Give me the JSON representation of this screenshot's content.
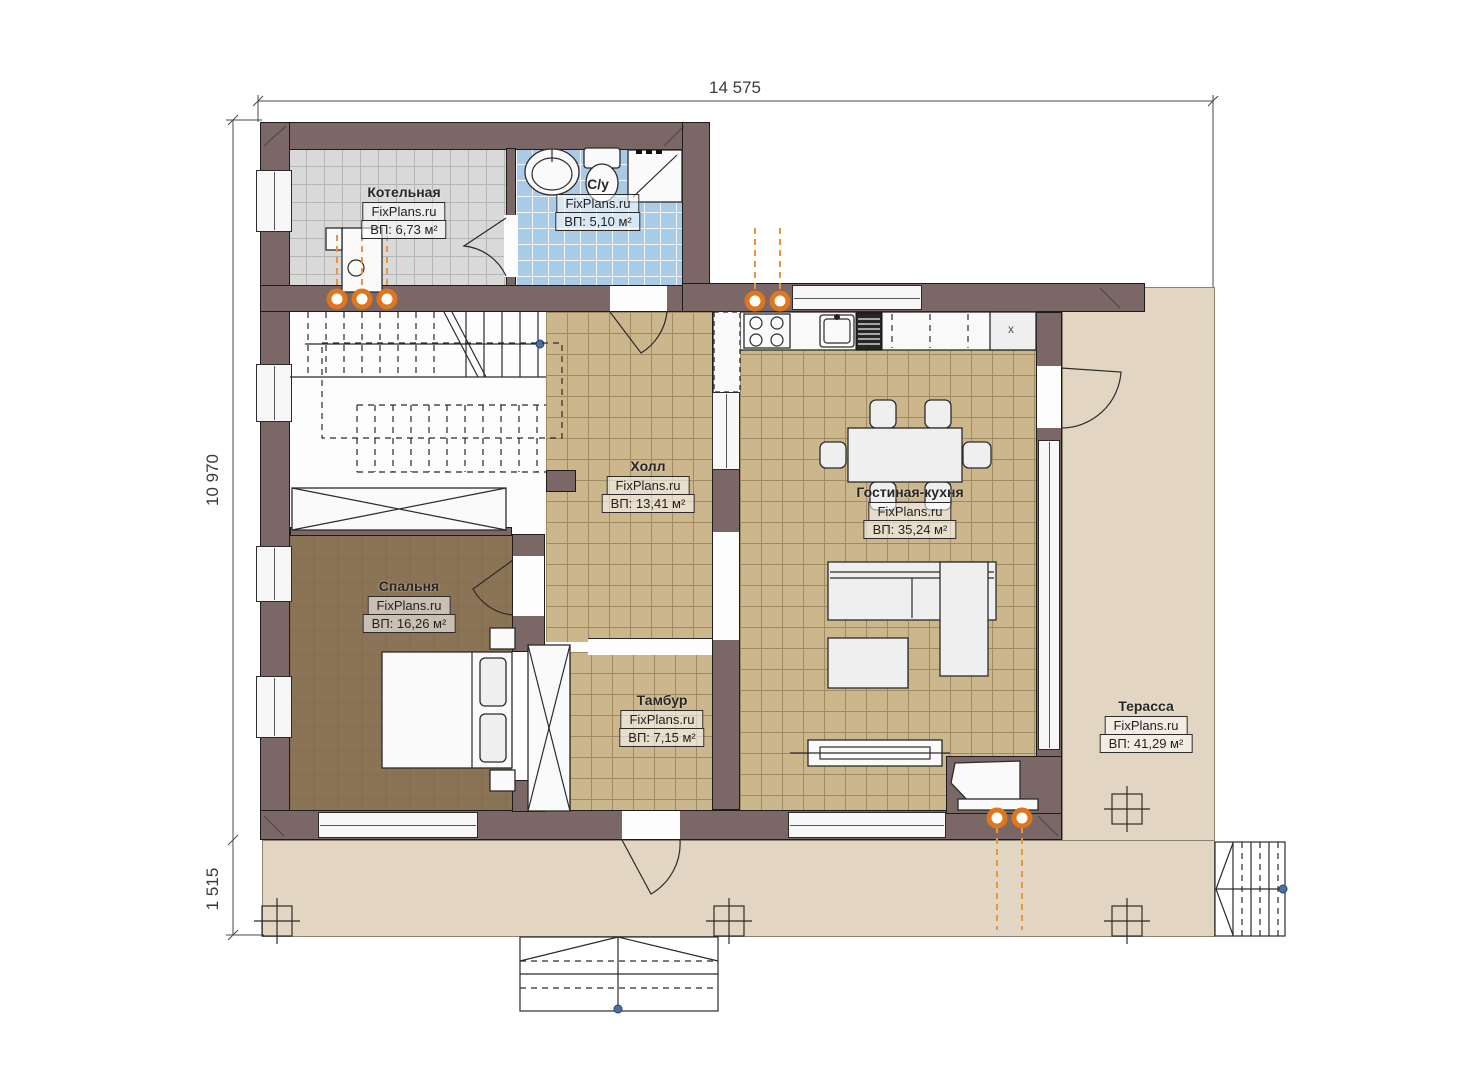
{
  "meta": {
    "drawing_type": "first floor plan",
    "watermark": "FixPlans.ru"
  },
  "dimensions": {
    "overall_width": "14 575",
    "overall_height": "10 970",
    "porch_depth": "1 515"
  },
  "rooms": [
    {
      "id": "boiler",
      "name": "Котельная",
      "watermark": "FixPlans.ru",
      "area": "ВП: 6,73 м²"
    },
    {
      "id": "bathroom",
      "name": "С/у",
      "watermark": "FixPlans.ru",
      "area": "ВП: 5,10 м²"
    },
    {
      "id": "hall",
      "name": "Холл",
      "watermark": "FixPlans.ru",
      "area": "ВП: 13,41 м²"
    },
    {
      "id": "living-kitchen",
      "name": "Гостиная-кухня",
      "watermark": "FixPlans.ru",
      "area": "ВП: 35,24 м²"
    },
    {
      "id": "bedroom",
      "name": "Спальня",
      "watermark": "FixPlans.ru",
      "area": "ВП: 16,26 м²"
    },
    {
      "id": "vestibule",
      "name": "Тамбур",
      "watermark": "FixPlans.ru",
      "area": "ВП: 7,15 м²"
    },
    {
      "id": "terrace",
      "name": "Терасса",
      "watermark": "FixPlans.ru",
      "area": "ВП: 41,29 м²"
    }
  ],
  "kitchen": {
    "cabinet_mark": "x"
  },
  "colors": {
    "wall": "#7b6766",
    "floor_boiler": "#d9d9d9",
    "floor_bathroom": "#a9cbe8",
    "floor_tiles": "#ccb68c",
    "floor_bedroom": "#8b7355",
    "terrace": "#e2d6c2",
    "radiator_accent": "#df751d"
  }
}
